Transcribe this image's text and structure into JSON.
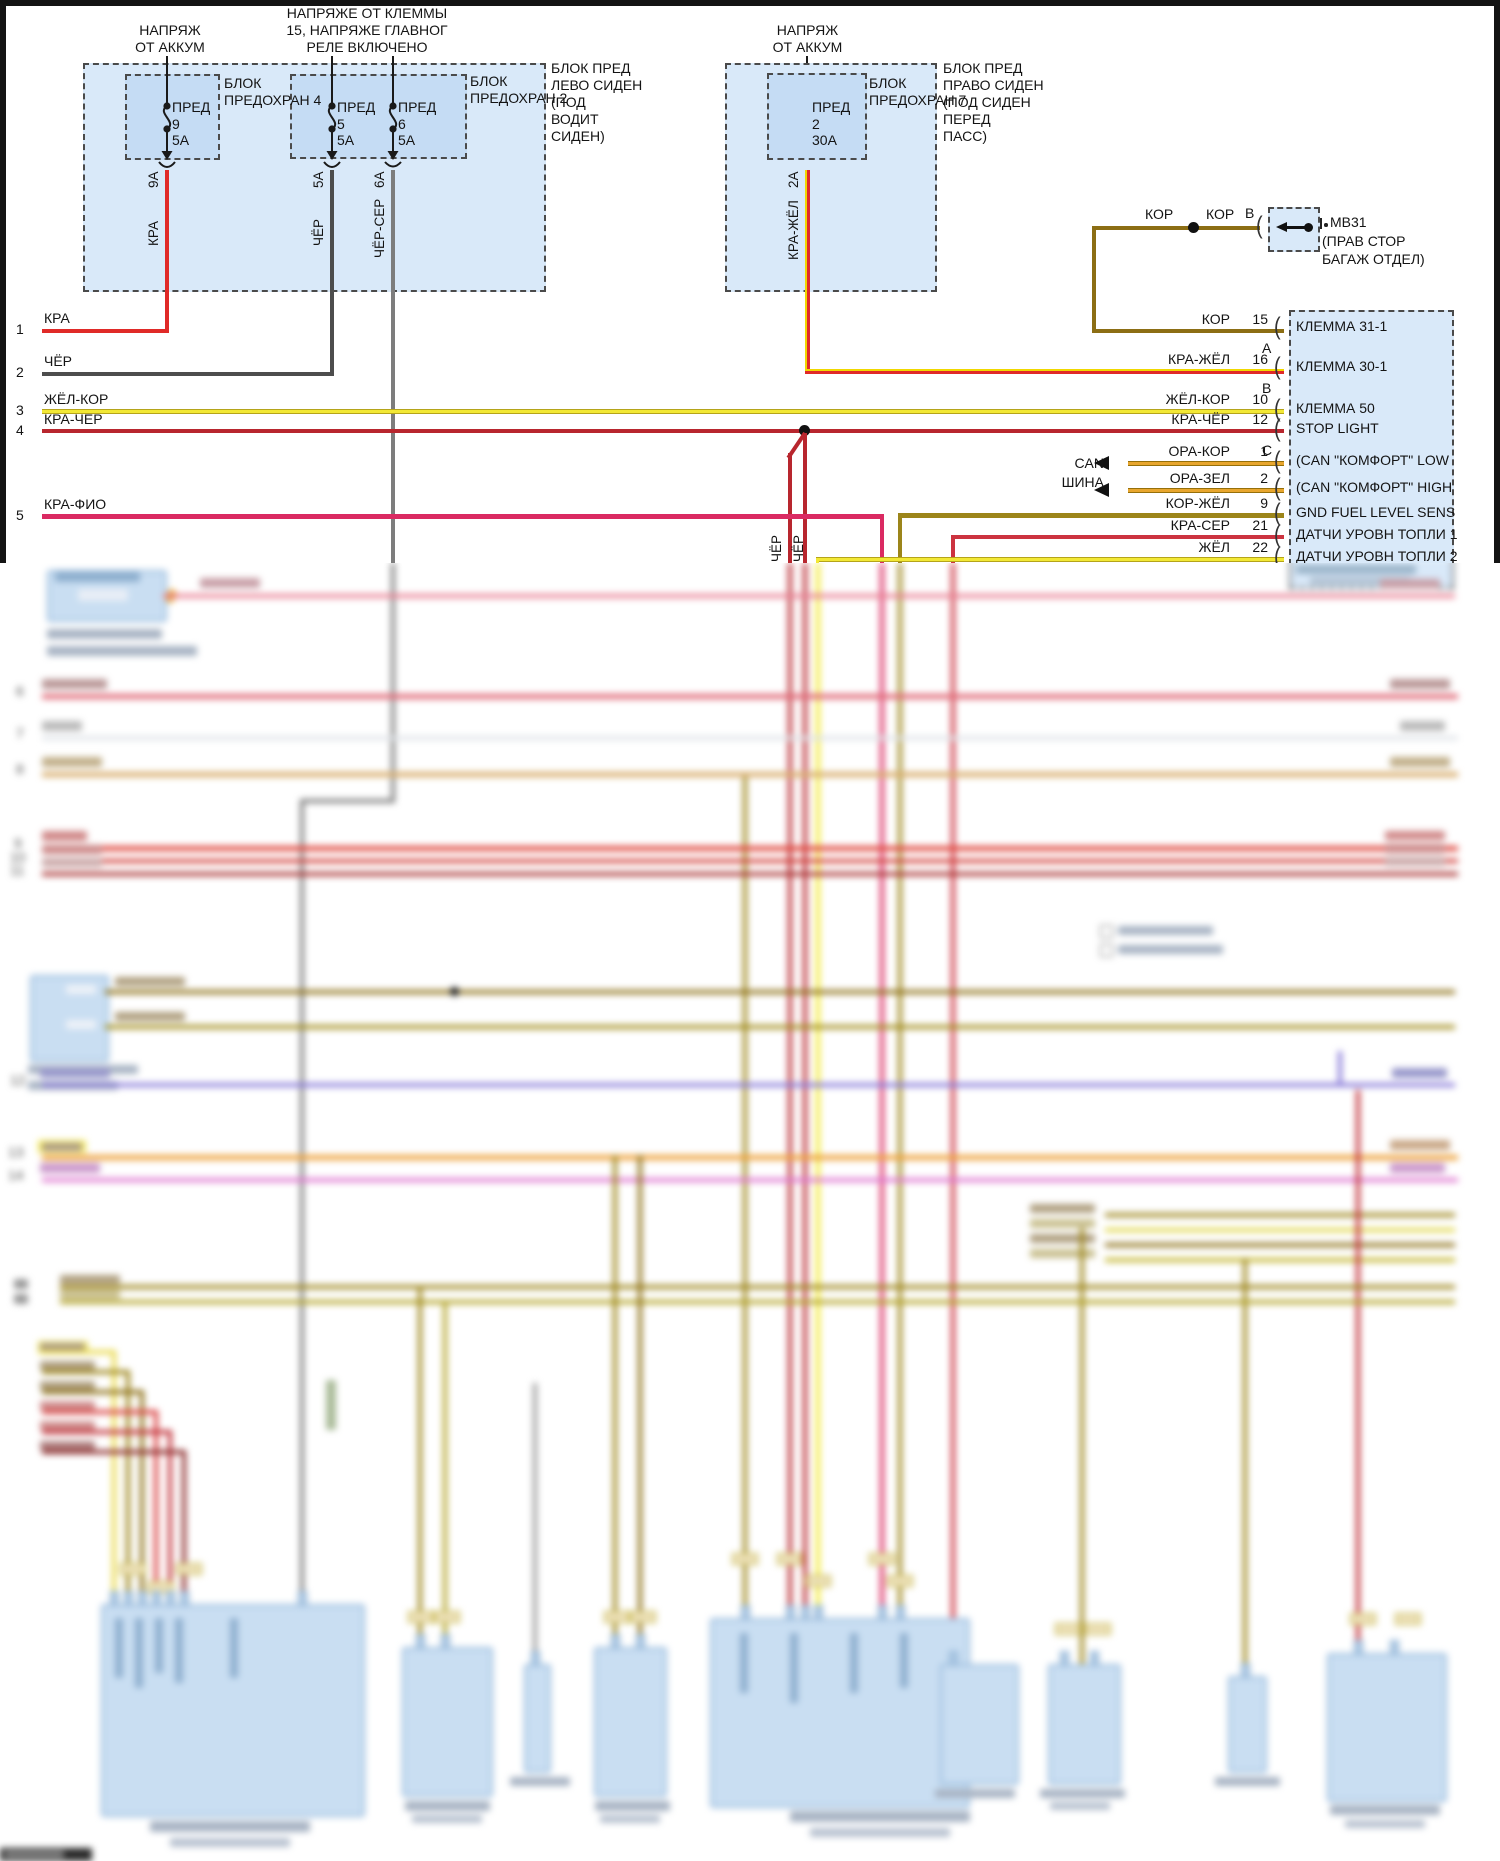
{
  "diagram": {
    "feeds": {
      "battery1": [
        "НАПРЯЖ",
        "ОТ АККУМ"
      ],
      "terminal15": [
        "НАПРЯЖЕ ОТ КЛЕММЫ",
        "15, НАПРЯЖЕ ГЛАВНОГ",
        "РЕЛЕ ВКЛЮЧЕНО"
      ],
      "battery2": [
        "НАПРЯЖ",
        "ОТ АККУМ"
      ]
    },
    "fuse_boxes": {
      "box4_label": [
        "БЛОК",
        "ПРЕДОХРАН 4"
      ],
      "box2_label": [
        "БЛОК",
        "ПРЕДОХРАН 2"
      ],
      "box7_label": [
        "БЛОК",
        "ПРЕДОХРАН 7"
      ],
      "left_location": [
        "БЛОК ПРЕД",
        "ЛЕВО СИДЕН",
        "(ПОД",
        "ВОДИТ",
        "СИДЕН)"
      ],
      "right_location": [
        "БЛОК ПРЕД",
        "ПРАВО СИДЕН",
        "(ПОД СИДЕН",
        "ПЕРЕД",
        "ПАСС)"
      ]
    },
    "fuses": [
      {
        "name": "ПРЕД",
        "num": "9",
        "amp": "5А",
        "rating": "9А",
        "wire": "КРА"
      },
      {
        "name": "ПРЕД",
        "num": "5",
        "amp": "5А",
        "rating": "5А",
        "wire": "ЧЁР"
      },
      {
        "name": "ПРЕД",
        "num": "6",
        "amp": "5А",
        "rating": "6А",
        "wire": "ЧЁР-СЕР"
      },
      {
        "name": "ПРЕД",
        "num": "2",
        "amp": "30А",
        "rating": "2А",
        "wire": "КРА-ЖЁЛ"
      }
    ],
    "ground": {
      "wire1": "КОР",
      "wire2": "КОР",
      "pin": "B",
      "name": "MB31",
      "loc1": "(ПРАВ СТОР",
      "loc2": "БАГАЖ ОТДЕЛ)"
    },
    "left_wires": [
      {
        "num": "1",
        "label": "КРА"
      },
      {
        "num": "2",
        "label": "ЧЁР"
      },
      {
        "num": "3",
        "label": "ЖЁЛ-КОР"
      },
      {
        "num": "4",
        "label": "КРА-ЧЁР"
      },
      {
        "num": "5",
        "label": "КРА-ФИО"
      }
    ],
    "branch_labels": [
      "ЧЁР",
      "ЧЁР"
    ],
    "can_bus": [
      "CAN",
      "ШИНА"
    ],
    "connector": {
      "rows": [
        {
          "wire": "КОР",
          "pin": "15",
          "letter": "A",
          "desc": "КЛЕММА 31-1"
        },
        {
          "wire": "КРА-ЖЁЛ",
          "pin": "16",
          "letter": "B",
          "desc": "КЛЕММА 30-1"
        },
        {
          "wire": "ЖЁЛ-КОР",
          "pin": "10",
          "letter": "",
          "desc": "КЛЕММА 50"
        },
        {
          "wire": "КРА-ЧЁР",
          "pin": "12",
          "letter": "C",
          "desc": "STOP LIGHT"
        },
        {
          "wire": "ОРА-КОР",
          "pin": "1",
          "letter": "",
          "desc": "(CAN \"КОМФОРТ\" LOW"
        },
        {
          "wire": "ОРА-ЗЕЛ",
          "pin": "2",
          "letter": "",
          "desc": "(CAN \"КОМФОРТ\" HIGH"
        },
        {
          "wire": "КОР-ЖЁЛ",
          "pin": "9",
          "letter": "",
          "desc": "GND FUEL LEVEL SENS"
        },
        {
          "wire": "КРА-СЕР",
          "pin": "21",
          "letter": "",
          "desc": "ДАТЧИ УРОВН ТОПЛИ 1"
        },
        {
          "wire": "ЖЁЛ",
          "pin": "22",
          "letter": "",
          "desc": "ДАТЧИ УРОВН ТОПЛИ 2"
        }
      ]
    },
    "blur_numbers": [
      "6",
      "7",
      "8",
      "9",
      "10",
      "11",
      "12",
      "13",
      "14"
    ],
    "colors": {
      "red": "#e02a28",
      "dark_red": "#b8262e",
      "black_wire": "#4d4d4d",
      "gray_wire": "#7d7d7d",
      "yellow": "#f2e835",
      "brown": "#8c6e14",
      "olive": "#9c851a",
      "orange": "#e8a62e",
      "crimson": "#da2a62",
      "red_gray": "#cc3340",
      "panel_fill": "#d9e9f9",
      "inner_fill": "#c5dcf4"
    }
  }
}
